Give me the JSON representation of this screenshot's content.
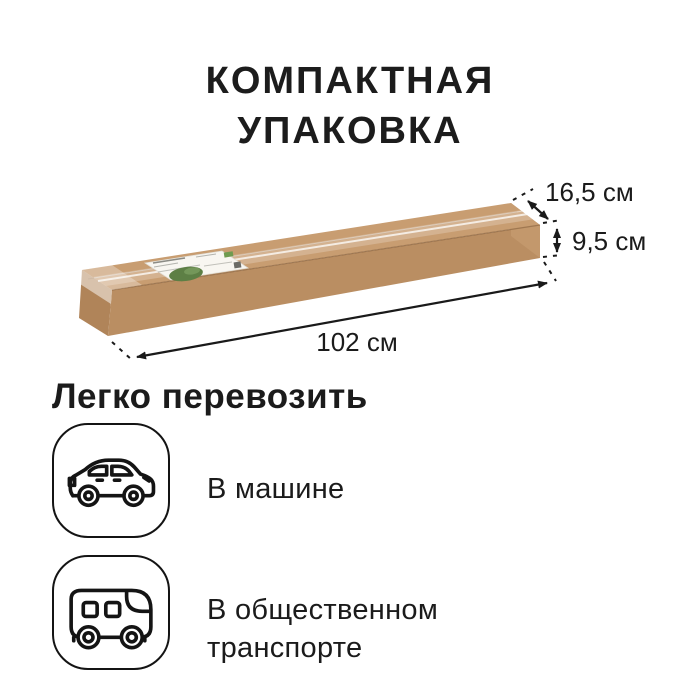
{
  "title": {
    "line1": "КОМПАКТНАЯ",
    "line2": "УПАКОВКА"
  },
  "box": {
    "dimensions": {
      "depth": "16,5 см",
      "height": "9,5 см",
      "length": "102 см"
    },
    "colors": {
      "top": "#c89d71",
      "front": "#ba8e62",
      "left_end": "#b08459",
      "right_end": "#c3986c",
      "label_bg": "#f8f6f1",
      "label_plant": "#5d7f45"
    }
  },
  "transport": {
    "heading": "Легко перевозить",
    "items": [
      {
        "icon": "car-icon",
        "label": "В машине"
      },
      {
        "icon": "bus-icon",
        "label_line1": "В общественном",
        "label_line2": "транспорте"
      }
    ]
  },
  "theme": {
    "background": "#ffffff",
    "text": "#1c1c1c",
    "line": "#1a1a1a",
    "icon_stroke": "#141414"
  }
}
